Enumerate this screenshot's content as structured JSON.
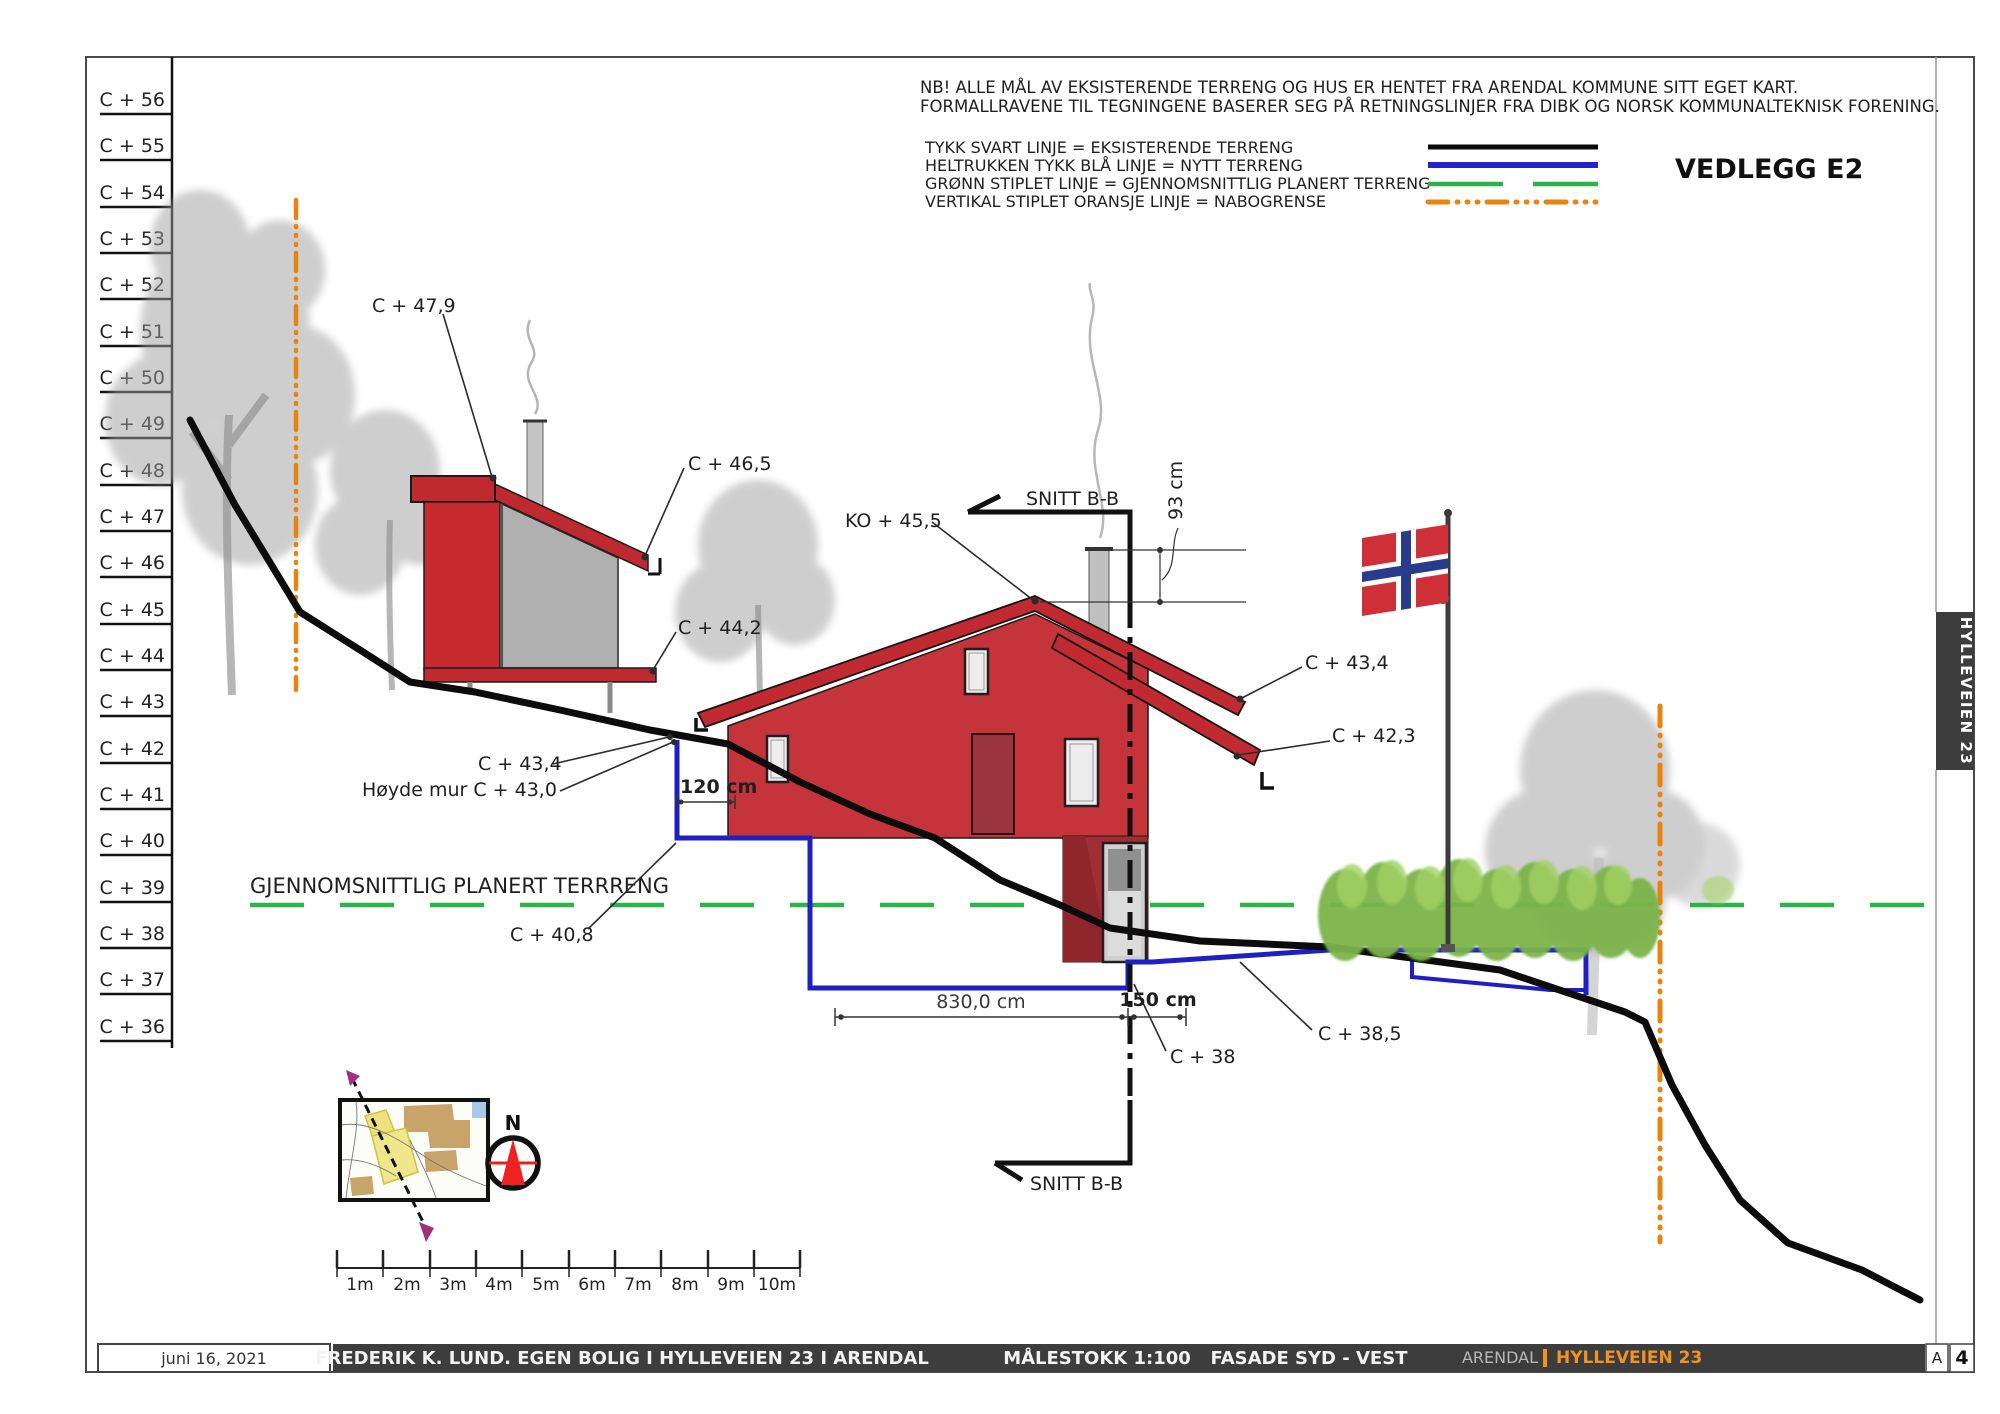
{
  "notes": {
    "line1": "NB! ALLE MÅL AV EKSISTERENDE TERRENG OG HUS ER HENTET FRA ARENDAL KOMMUNE SITT EGET KART.",
    "line2": "FORMALLRAVENE TIL TEGNINGENE BASERER SEG PÅ RETNINGSLINJER FRA DIBK OG NORSK KOMMUNALTEKNISK FORENING."
  },
  "legend": {
    "black": "TYKK SVART LINJE = EKSISTERENDE TERRENG",
    "blue": "HELTRUKKEN TYKK BLÅ LINJE = NYTT TERRENG",
    "green": "GRØNN STIPLET LINJE = GJENNOMSNITTLIG PLANERT TERRENG",
    "orange": "VERTIKAL STIPLET ORANSJE LINJE = NABOGRENSE"
  },
  "attachment_title": "VEDLEGG E2",
  "elevation_scale": {
    "labels": [
      "C + 56",
      "C + 55",
      "C + 54",
      "C + 53",
      "C + 52",
      "C + 51",
      "C + 50",
      "C + 49",
      "C + 48",
      "C + 47",
      "C + 46",
      "C + 45",
      "C + 44",
      "C + 43",
      "C + 42",
      "C + 41",
      "C + 40",
      "C + 39",
      "C + 38",
      "C + 37",
      "C + 36"
    ]
  },
  "annotations": {
    "annex_roof_top": "C + 47,9",
    "annex_roof_eave": "C + 46,5",
    "annex_base": "C + 44,2",
    "ridge": "KO + 45,5",
    "section_top": "SNITT B-B",
    "section_bottom": "SNITT B-B",
    "chimney_height": "93 cm",
    "eave_upper_right": "C + 43,4",
    "eave_lower_right": "C + 42,3",
    "eave_left": "C + 43,4",
    "wall_height": "Høyde mur C + 43,0",
    "wall_dim": "120 cm",
    "avg_terrain": "GJENNOMSNITTLIG PLANERT TERRRENG",
    "avg_terrain_level": "C + 40,8",
    "foundation_width": "830,0 cm",
    "foundation_offset": "150 cm",
    "level_38": "C + 38",
    "level_38_5": "C + 38,5"
  },
  "compass": {
    "north_label": "N"
  },
  "scale_bar": {
    "labels": [
      "1m",
      "2m",
      "3m",
      "4m",
      "5m",
      "6m",
      "7m",
      "8m",
      "9m",
      "10m"
    ]
  },
  "side_tab": {
    "label": "HYLLEVEIEN 23"
  },
  "title_block": {
    "date": "juni 16, 2021",
    "project": "FREDERIK K. LUND. EGEN BOLIG I HYLLEVEIEN 23 I ARENDAL",
    "scale": "MÅLESTOKK 1:100",
    "view": "FASADE SYD - VEST",
    "municipality": "ARENDAL",
    "street": "HYLLEVEIEN 23",
    "revision": "A",
    "sheet_number": "4"
  },
  "colors": {
    "drawing_red": "#c5343a",
    "terrain_blue": "#1f1fc4",
    "terrain_green": "#2db34a",
    "boundary_orange": "#e8830e",
    "accent_orange": "#f29222"
  }
}
